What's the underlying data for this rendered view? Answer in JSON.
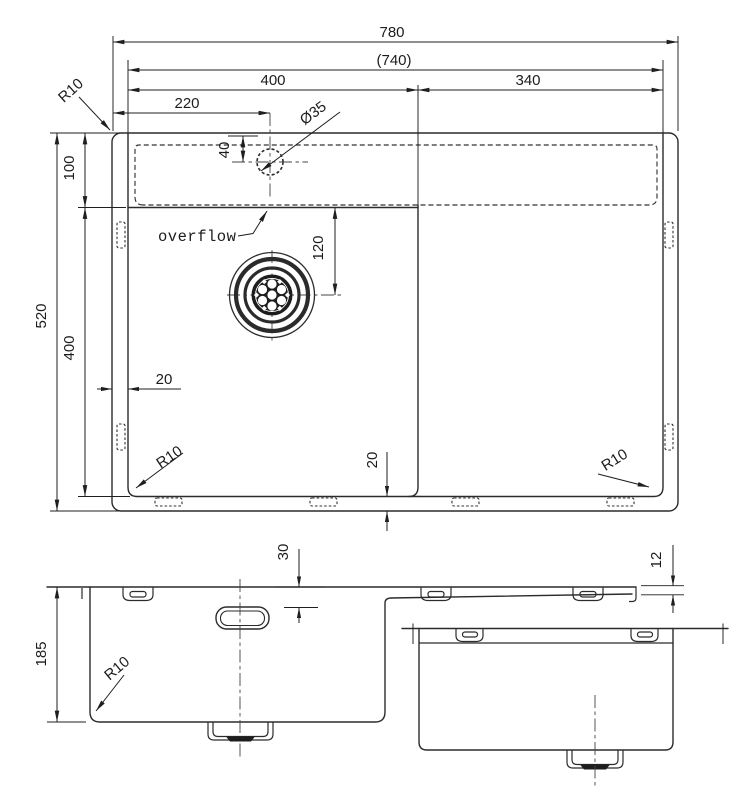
{
  "drawing": {
    "title": "sink-technical-drawing",
    "line_color": "#2b2b2b",
    "background": "#ffffff",
    "plan": {
      "dims": {
        "overall_width": "780",
        "inner_width": "(740)",
        "left_bowl_width": "400",
        "right_bowl_width": "340",
        "faucet_offset": "220",
        "overall_depth": "520",
        "deck_depth": "100",
        "bowl_depth": "400",
        "drain_offset": "120",
        "faucet_hole_dia": "Ø35",
        "faucet_hole_offset": "40",
        "edge_margin": "20",
        "corner_radius": "R10"
      },
      "annotations": {
        "overflow_label": "overflow"
      }
    },
    "front": {
      "dims": {
        "bowl_height": "185",
        "overflow_offset": "30",
        "rim_edge_height": "12",
        "corner_radius": "R10"
      }
    }
  }
}
